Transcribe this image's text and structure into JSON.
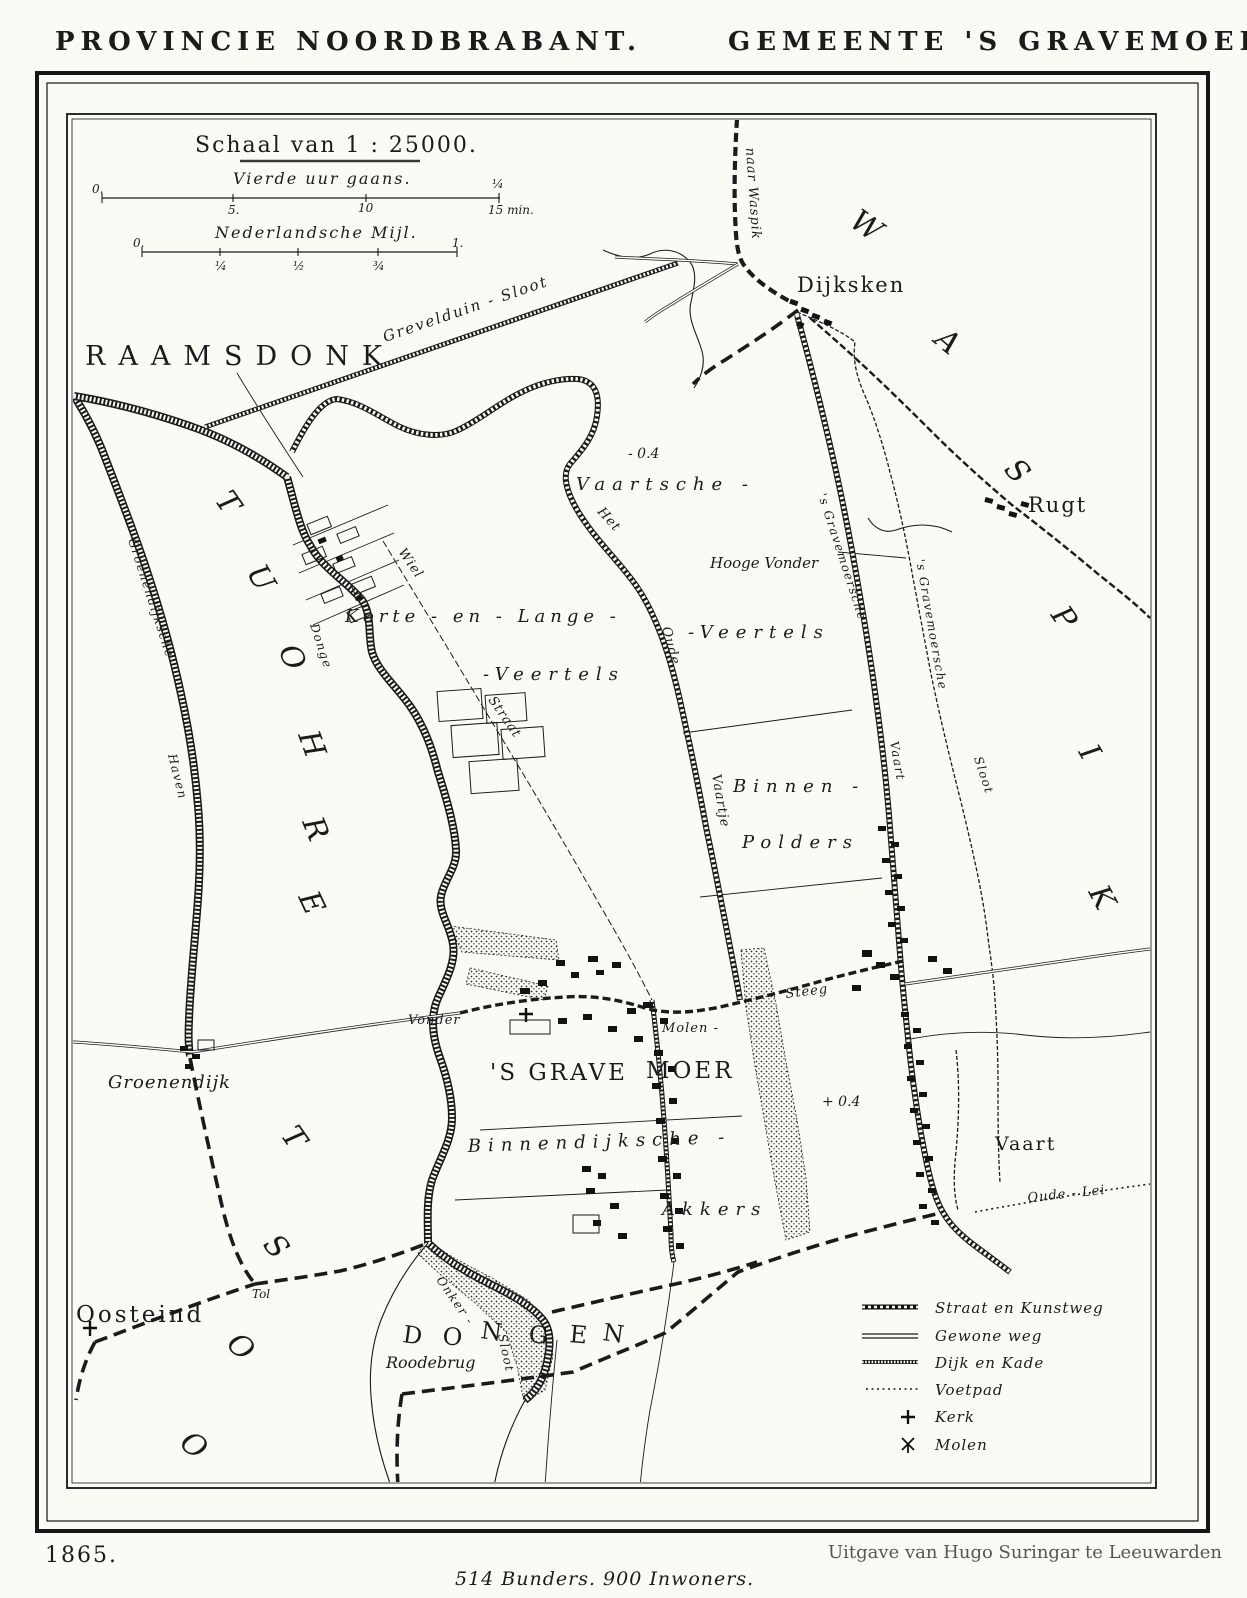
{
  "page": {
    "header_left": "PROVINCIE NOORDBRABANT.",
    "header_right": "GEMEENTE 'S GRAVEMOER.",
    "footer_year": "1865.",
    "footer_publisher": "Uitgave van Hugo Suringar te Leeuwarden",
    "footer_stats": "514 Bunders. 900 Inwoners."
  },
  "colors": {
    "ink": "#1b1b1b",
    "paper": "#fbfaf5",
    "faded": "#555555"
  },
  "scale_block": {
    "title": "Schaal van 1 : 25000.",
    "bar1_label": "Vierde uur gaans.",
    "bar1_ticks": [
      "0.",
      "5.",
      "10",
      "¼",
      "15 min."
    ],
    "bar2_label": "Nederlandsche Mijl.",
    "bar2_ticks": [
      "0.",
      "¼",
      "½",
      "¾",
      "1."
    ]
  },
  "legend": {
    "items": [
      {
        "symbol": "paved-road-symbol",
        "label": "Straat en Kunstweg"
      },
      {
        "symbol": "plain-road-symbol",
        "label": "Gewone weg"
      },
      {
        "symbol": "dike-symbol",
        "label": "Dijk en Kade"
      },
      {
        "symbol": "footpath-symbol",
        "label": "Voetpad"
      },
      {
        "symbol": "church-symbol",
        "label": "Kerk"
      },
      {
        "symbol": "windmill-symbol",
        "label": "Molen"
      }
    ]
  },
  "map": {
    "neighbors": {
      "raamsdonk": "RAAMSDONK",
      "waspik": "WASPIK",
      "oosterhout": "OOSTERHOUT",
      "dongen": "DONGEN"
    },
    "settlements": {
      "gravemoer_1": "'S GRAVE",
      "gravemoer_2": "MOER",
      "dijksken": "Dijksken",
      "rugt": "Rugt",
      "vaart": "Vaart",
      "oosteind": "Oosteind",
      "groenendijk": "Groenendijk",
      "roodebrug": "Roodebrug"
    },
    "areas": {
      "vaartsche": "Vaartsche -",
      "veertels_east": "-Veertels",
      "korte_lange": "Korte - en - Lange -",
      "veertels_west": "-Veertels",
      "binnen": "Binnen -",
      "polders": "Polders",
      "binnendijksche": "Binnendijksche -",
      "akkers": "Akkers"
    },
    "waterways": {
      "grevelduin_sloot": "Grevelduin - Sloot",
      "het": "Het",
      "oude": "Oude",
      "vaartje": "Vaartje",
      "gravemoersche_road": "'s Gravemoersche",
      "vaart_road": "Vaart",
      "gravemoersche_sloot": "'s Gravemoersche",
      "sloot_east": "Sloot",
      "donge": "Donge",
      "groenendijksche": "Groenendijksche",
      "haven": "Haven",
      "onker": "Onker -",
      "onker_sloot": "Sloot",
      "oude_lei": "Oude - Lei"
    },
    "roads": {
      "naar_waspik": "naar Waspik",
      "wiel": "Wiel",
      "straat": "Straat",
      "molen_steeg_1": "Molen -",
      "molen_steeg_2": "Steeg"
    },
    "landmarks": {
      "hooge_vonder": "Hooge Vonder",
      "vonder": "Vonder",
      "tol": "Tol"
    },
    "elevations": {
      "neg": "- 0.4",
      "pos": "+ 0.4"
    }
  }
}
